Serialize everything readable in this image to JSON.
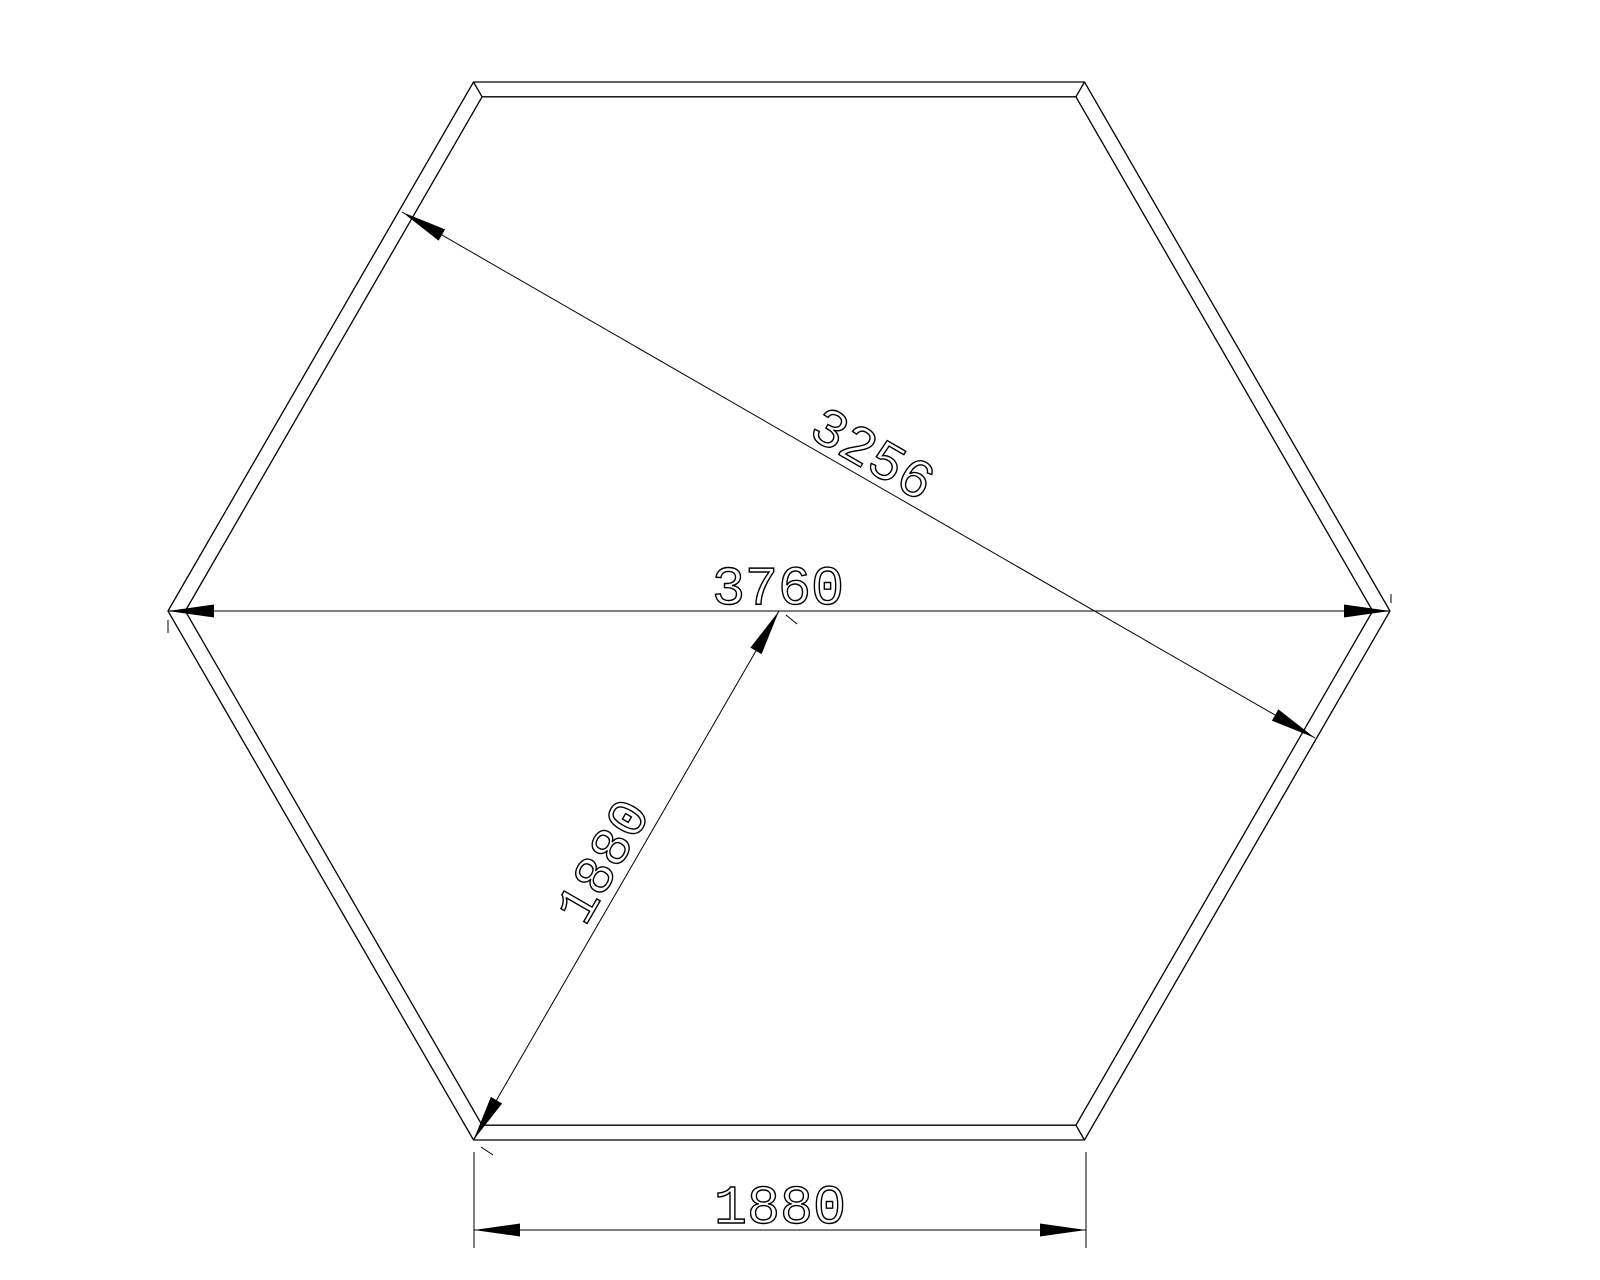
{
  "diagram": {
    "background": "#ffffff",
    "line_color": "#000000",
    "shape": "hexagon-plan-drawing",
    "dimensions": {
      "across_flats": "3256",
      "width_across_corners": "3760",
      "radius": "1880",
      "bottom_side": "1880"
    }
  }
}
